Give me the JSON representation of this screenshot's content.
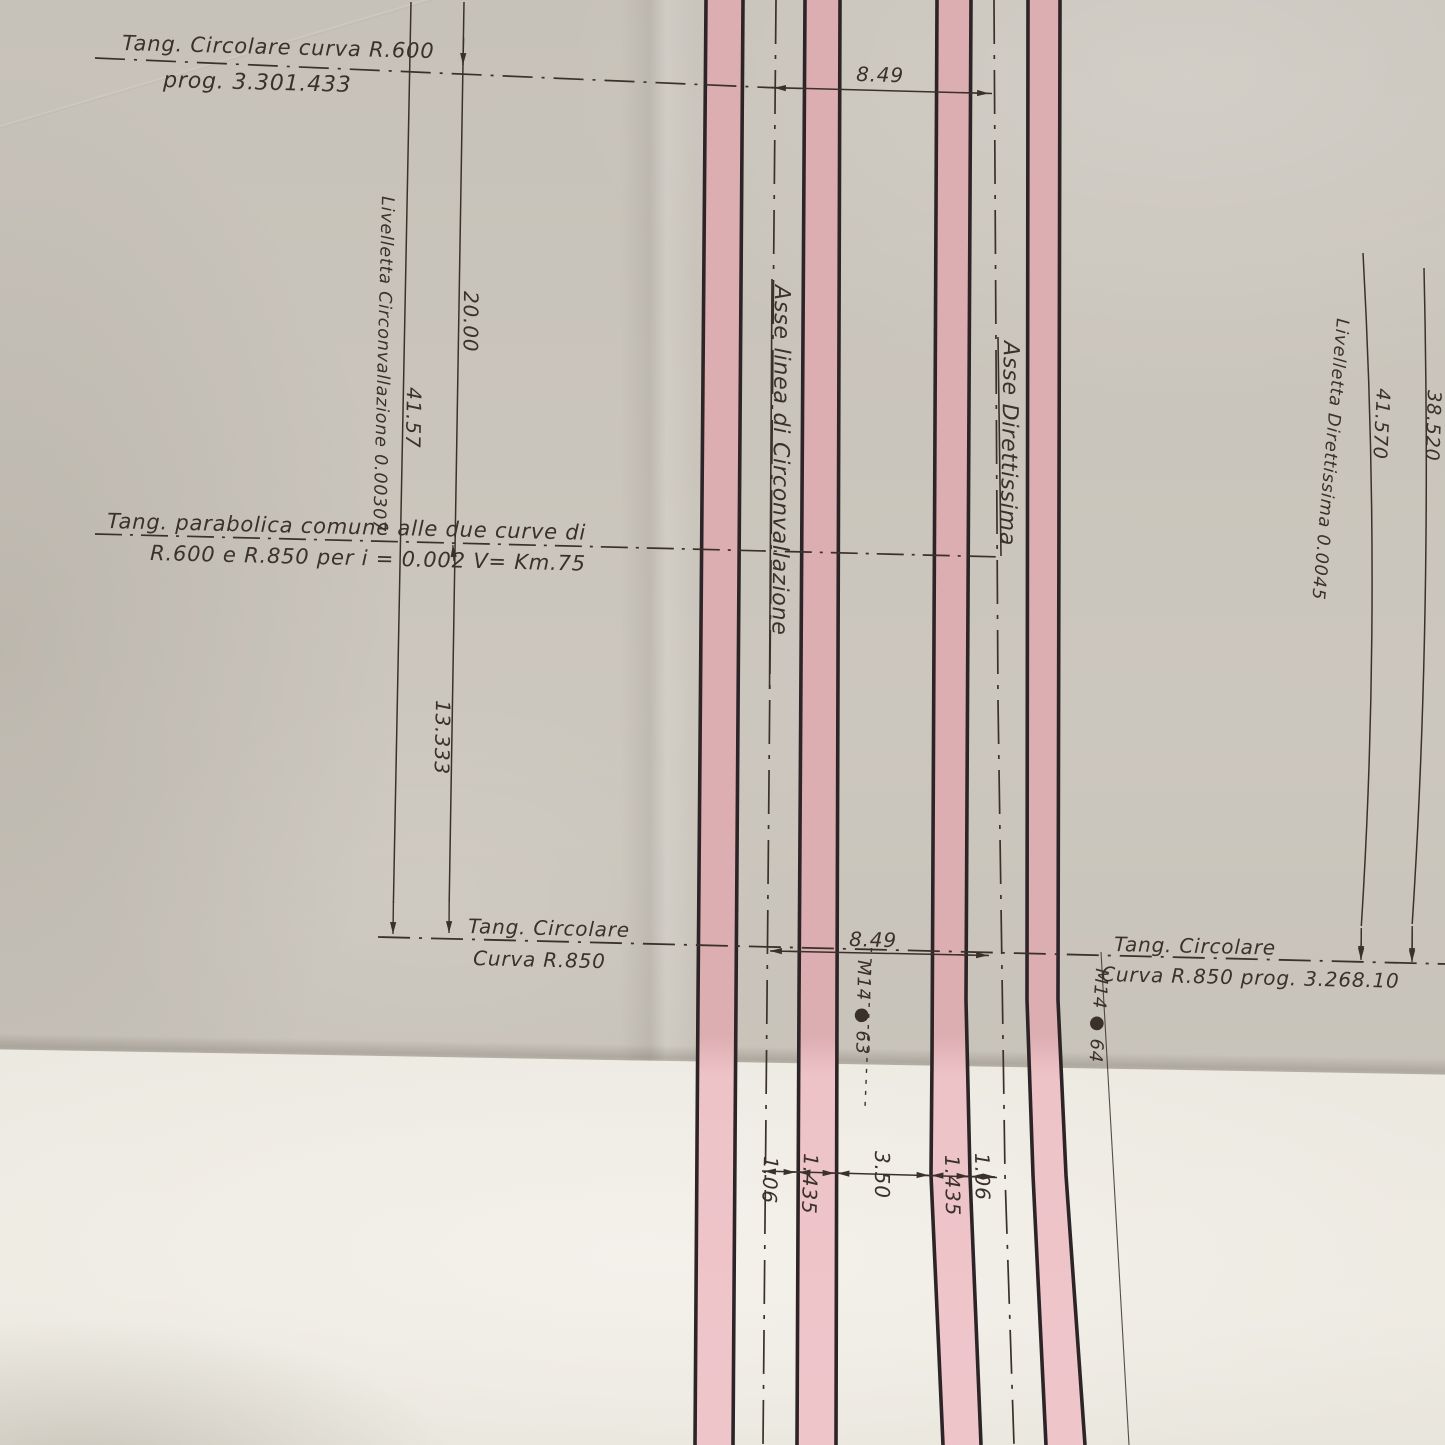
{
  "document": {
    "kind": "photograph of an Italian railway alignment engineering drawing, folded paper with pink track bands",
    "colors": {
      "paper": "#c9c4bb",
      "paper_bright_fold": "#f0eee7",
      "track_band_pink": "#dcadb1",
      "track_band_pink_bright": "#eec6ca",
      "rail_edge_black": "#2d2427",
      "ink": "#3a312b"
    },
    "labels": {
      "tang_r600_line1": "Tang. Circolare curva R.600",
      "tang_r600_line2": "prog. 3.301.433",
      "livelletta_circonvallazione": "Livelletta Circonvallazione 0.00307",
      "dim_20_00": "20.00",
      "dim_41_57": "41.57",
      "tang_parabolica_line1": "Tang. parabolica comune alle due curve di",
      "tang_parabolica_line2": "R.600 e R.850 per  i = 0.002    V= Km.75",
      "dim_13_333": "13.333",
      "tang_r850_left_line1": "Tang. Circolare",
      "tang_r850_left_line2": "Curva R.850",
      "asse_circonvallazione": "Asse linea di Circonvallazione",
      "asse_direttissima": "Asse Direttissima",
      "dim_8_49_top": "8.49",
      "dim_8_49_bottom": "8.49",
      "livelletta_direttissima": "Livelletta Direttissima 0.0045",
      "dim_41_570": "41.570",
      "dim_38_520": "38.520",
      "tang_r850_right_line1": "Tang. Circolare",
      "tang_r850_right_line2": "Curva R.850    prog. 3.268.10",
      "marker_63": "M14 ● 63",
      "marker_64": "M14 ● 64",
      "gauge": [
        "1.06",
        "1.435",
        "3.50",
        "1.435",
        "1.06"
      ]
    }
  }
}
